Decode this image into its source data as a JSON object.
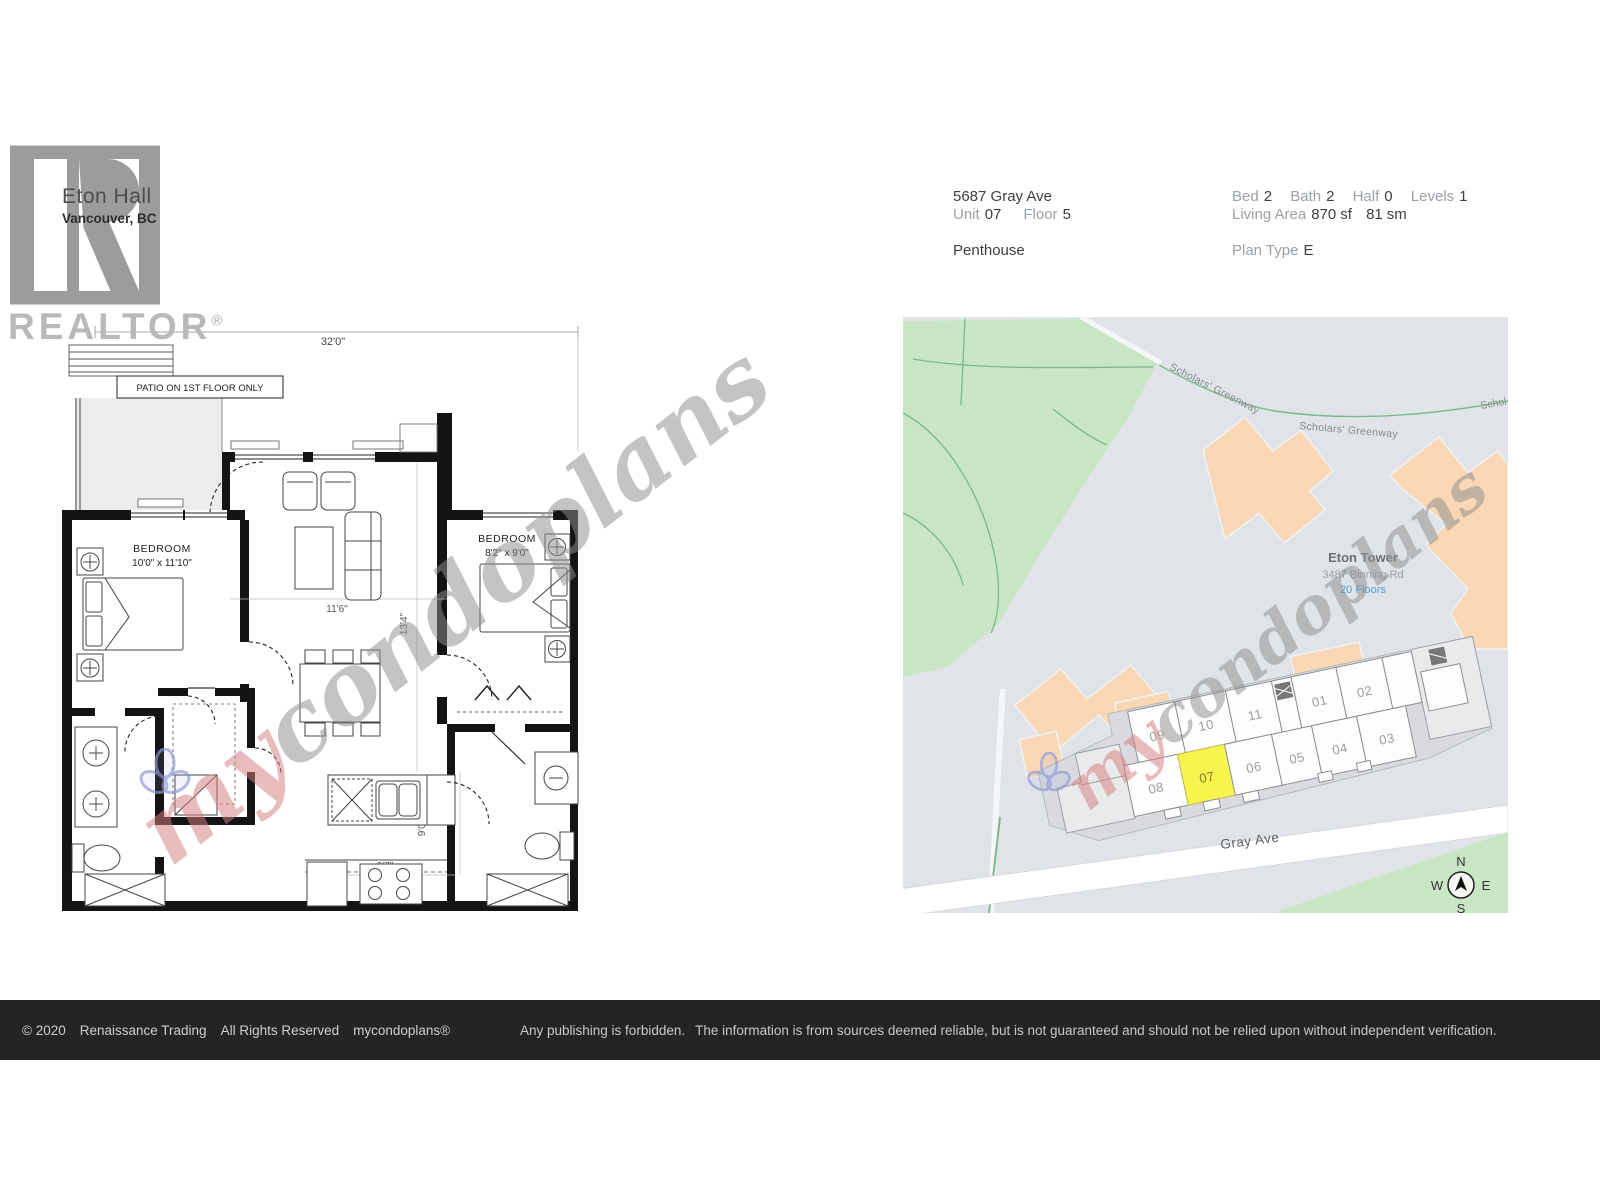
{
  "branding": {
    "building_name": "Eton Hall",
    "city": "Vancouver, BC",
    "realtor_text": "REALTOR",
    "realtor_reg": "®"
  },
  "property": {
    "address": "5687 Gray Ave",
    "unit_label": "Unit",
    "unit_value": "07",
    "floor_label": "Floor",
    "floor_value": "5",
    "type": "Penthouse",
    "bed_label": "Bed",
    "bed": "2",
    "bath_label": "Bath",
    "bath": "2",
    "half_label": "Half",
    "half": "0",
    "levels_label": "Levels",
    "levels": "1",
    "living_area_label": "Living Area",
    "living_area_sf": "870",
    "sf_unit": "sf",
    "living_area_sm": "81",
    "sm_unit": "sm",
    "plan_type_label": "Plan Type",
    "plan_type": "E"
  },
  "floorplan": {
    "dim_top": "32'0\"",
    "patio_note": "PATIO ON 1ST FLOOR ONLY",
    "bedroom1_label": "BEDROOM",
    "bedroom1_size": "10'0\" x 11'10\"",
    "bedroom2_label": "BEDROOM",
    "bedroom2_size": "8'2\" x 9'0\"",
    "dim_living": "11'6\"",
    "dim_living_v": "13'4\"",
    "dim_kitchen": "9'7\"",
    "dim_kitchen_v": "9'0\""
  },
  "map": {
    "street1a": "Scholars' Greenway",
    "street1b": "Scholars' Greenway",
    "street1c": "Schol",
    "tower_name": "Eton Tower",
    "tower_address": "3487 Binning Rd",
    "tower_floors": "20 Floors",
    "street2": "Gray Ave",
    "units_top": [
      "09",
      "10",
      "11",
      "01",
      "02"
    ],
    "units_bottom": [
      "08",
      "07",
      "06",
      "05",
      "04",
      "03"
    ],
    "highlighted_unit": "07",
    "compass": {
      "n": "N",
      "e": "E",
      "s": "S",
      "w": "W"
    },
    "colors": {
      "park": "#c8e6c3",
      "building_fill": "#fad7b5",
      "road_label": "#5f6368",
      "highlight": "#f7f44e",
      "floors_link": "#4a9fd8",
      "map_bg": "#e0e4e9"
    }
  },
  "watermark": {
    "text_my": "my",
    "text_rest": "condoplans"
  },
  "footer": {
    "copyright": "© 2020",
    "company": "Renaissance Trading",
    "rights": "All Rights Reserved",
    "brand": "mycondoplans®",
    "disclaimer1": "Any publishing is forbidden.",
    "disclaimer2": "The information is from sources deemed reliable, but is not guaranteed and should not be relied upon without independent verification."
  }
}
